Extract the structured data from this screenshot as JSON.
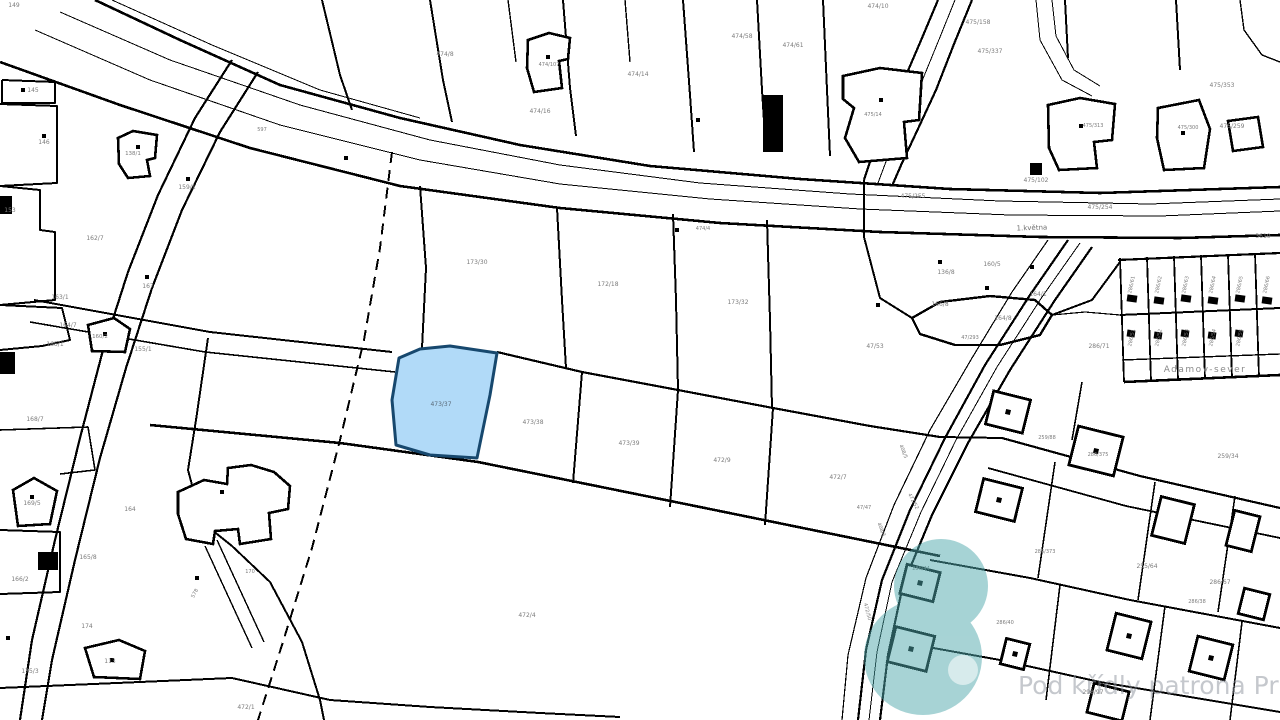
{
  "map": {
    "type": "cadastral-map",
    "background": "#ffffff",
    "line_color": "#000000",
    "label_color": "#7b7b7b",
    "highlight": {
      "parcel_number": "473/37",
      "fill": "#a9d6f7",
      "stroke": "#17486e",
      "points": "399,358 420,349 450,346 497,353 490,395 477,458 430,455 396,445 392,400",
      "label_x": 441,
      "label_y": 406,
      "label_color": "#5a6a78"
    },
    "watermark": {
      "text": "Pod křídly patrona Prahy",
      "text_color": "rgba(140,145,155,0.5)",
      "x": 1018,
      "y": 694,
      "size": 25,
      "logo_color": "#4fa8ac",
      "logo_opacity": 0.5
    },
    "street_labels": [
      {
        "t": "1.května",
        "x": 1032,
        "y": 230,
        "s": 7,
        "c": "#6f6f6f",
        "r": -2
      },
      {
        "t": "Adamov-sever",
        "x": 1205,
        "y": 372,
        "s": 9,
        "c": "#8a8a8a",
        "ls": 1.5
      }
    ],
    "parcel_labels": [
      {
        "t": "149",
        "x": 14,
        "y": 7
      },
      {
        "t": "145",
        "x": 33,
        "y": 92
      },
      {
        "t": "146",
        "x": 44,
        "y": 144
      },
      {
        "t": "138/1",
        "x": 133,
        "y": 155,
        "s": 5.5
      },
      {
        "t": "159/1",
        "x": 187,
        "y": 189
      },
      {
        "t": "597",
        "x": 262,
        "y": 131,
        "s": 5
      },
      {
        "t": "153",
        "x": 10,
        "y": 212
      },
      {
        "t": "162/7",
        "x": 95,
        "y": 240
      },
      {
        "t": "167",
        "x": 148,
        "y": 288
      },
      {
        "t": "163/1",
        "x": 60,
        "y": 299
      },
      {
        "t": "164/7",
        "x": 68,
        "y": 327
      },
      {
        "t": "165/1",
        "x": 55,
        "y": 346
      },
      {
        "t": "160/2",
        "x": 100,
        "y": 338,
        "s": 5.5
      },
      {
        "t": "155/1",
        "x": 143,
        "y": 351
      },
      {
        "t": "168/7",
        "x": 35,
        "y": 421
      },
      {
        "t": "169/5",
        "x": 32,
        "y": 505
      },
      {
        "t": "165/8",
        "x": 88,
        "y": 559
      },
      {
        "t": "166/2",
        "x": 20,
        "y": 581
      },
      {
        "t": "174",
        "x": 87,
        "y": 628
      },
      {
        "t": "113",
        "x": 110,
        "y": 663
      },
      {
        "t": "175/3",
        "x": 30,
        "y": 673
      },
      {
        "t": "164",
        "x": 130,
        "y": 511
      },
      {
        "t": "170",
        "x": 250,
        "y": 573,
        "s": 5
      },
      {
        "t": "578",
        "x": 196,
        "y": 594,
        "r": -62,
        "s": 5
      },
      {
        "t": "472/1",
        "x": 246,
        "y": 709
      },
      {
        "t": "474/8",
        "x": 445,
        "y": 56
      },
      {
        "t": "474/107",
        "x": 549,
        "y": 66,
        "s": 5
      },
      {
        "t": "474/16",
        "x": 540,
        "y": 113
      },
      {
        "t": "474/14",
        "x": 638,
        "y": 76
      },
      {
        "t": "474/58",
        "x": 742,
        "y": 38
      },
      {
        "t": "474/61",
        "x": 793,
        "y": 47
      },
      {
        "t": "474/10",
        "x": 878,
        "y": 8
      },
      {
        "t": "474/4",
        "x": 703,
        "y": 230,
        "s": 5
      },
      {
        "t": "475/158",
        "x": 978,
        "y": 24
      },
      {
        "t": "475/337",
        "x": 990,
        "y": 53
      },
      {
        "t": "475/313",
        "x": 1093,
        "y": 127,
        "s": 5
      },
      {
        "t": "475/353",
        "x": 1222,
        "y": 87
      },
      {
        "t": "475/14",
        "x": 873,
        "y": 116,
        "s": 5
      },
      {
        "t": "475/300",
        "x": 1188,
        "y": 129,
        "s": 5
      },
      {
        "t": "475/259",
        "x": 1232,
        "y": 128
      },
      {
        "t": "475/102",
        "x": 1036,
        "y": 182
      },
      {
        "t": "475/255",
        "x": 913,
        "y": 198
      },
      {
        "t": "475/254",
        "x": 1100,
        "y": 209
      },
      {
        "t": "3610",
        "x": 1263,
        "y": 238
      },
      {
        "t": "173/30",
        "x": 477,
        "y": 264
      },
      {
        "t": "172/18",
        "x": 608,
        "y": 286
      },
      {
        "t": "173/32",
        "x": 738,
        "y": 304
      },
      {
        "t": "136/8",
        "x": 946,
        "y": 274
      },
      {
        "t": "160/5",
        "x": 992,
        "y": 266
      },
      {
        "t": "164/1",
        "x": 1038,
        "y": 296
      },
      {
        "t": "164/8",
        "x": 1003,
        "y": 320
      },
      {
        "t": "166/8",
        "x": 940,
        "y": 306
      },
      {
        "t": "47/293",
        "x": 970,
        "y": 339,
        "s": 5
      },
      {
        "t": "47/53",
        "x": 875,
        "y": 348
      },
      {
        "t": "286/71",
        "x": 1099,
        "y": 348
      },
      {
        "t": "473/38",
        "x": 533,
        "y": 424
      },
      {
        "t": "473/39",
        "x": 629,
        "y": 445
      },
      {
        "t": "472/9",
        "x": 722,
        "y": 462
      },
      {
        "t": "472/7",
        "x": 838,
        "y": 479
      },
      {
        "t": "47/47",
        "x": 864,
        "y": 509,
        "s": 5
      },
      {
        "t": "472/4",
        "x": 527,
        "y": 617
      },
      {
        "t": "259/88",
        "x": 1047,
        "y": 439,
        "s": 5
      },
      {
        "t": "286/375",
        "x": 1098,
        "y": 456,
        "s": 5
      },
      {
        "t": "259/34",
        "x": 1228,
        "y": 458
      },
      {
        "t": "286/373",
        "x": 1045,
        "y": 553,
        "s": 5
      },
      {
        "t": "255/64",
        "x": 1147,
        "y": 568
      },
      {
        "t": "286/67",
        "x": 1220,
        "y": 584
      },
      {
        "t": "286/38",
        "x": 1197,
        "y": 603,
        "s": 5
      },
      {
        "t": "298/97",
        "x": 1093,
        "y": 694
      },
      {
        "t": "286/44",
        "x": 921,
        "y": 570,
        "s": 5
      },
      {
        "t": "286/40",
        "x": 1005,
        "y": 624,
        "s": 5
      },
      {
        "t": "472/52",
        "x": 912,
        "y": 502,
        "r": 62,
        "s": 5
      },
      {
        "t": "408/5",
        "x": 902,
        "y": 452,
        "r": 68,
        "s": 5
      },
      {
        "t": "408/3",
        "x": 880,
        "y": 530,
        "r": 68,
        "s": 5
      },
      {
        "t": "472/50",
        "x": 866,
        "y": 612,
        "r": 75,
        "s": 5
      },
      {
        "t": "286/61",
        "x": 1133,
        "y": 285,
        "r": -78,
        "s": 5
      },
      {
        "t": "286/62",
        "x": 1160,
        "y": 285,
        "r": -78,
        "s": 5
      },
      {
        "t": "286/63",
        "x": 1187,
        "y": 285,
        "r": -78,
        "s": 5
      },
      {
        "t": "286/64",
        "x": 1214,
        "y": 285,
        "r": -78,
        "s": 5
      },
      {
        "t": "286/65",
        "x": 1241,
        "y": 285,
        "r": -78,
        "s": 5
      },
      {
        "t": "286/66",
        "x": 1268,
        "y": 285,
        "r": -78,
        "s": 5
      },
      {
        "t": "286/51",
        "x": 1133,
        "y": 338,
        "r": -78,
        "s": 5
      },
      {
        "t": "286/52",
        "x": 1160,
        "y": 338,
        "r": -78,
        "s": 5
      },
      {
        "t": "286/53",
        "x": 1187,
        "y": 338,
        "r": -78,
        "s": 5
      },
      {
        "t": "286/54",
        "x": 1214,
        "y": 338,
        "r": -78,
        "s": 5
      },
      {
        "t": "286/55",
        "x": 1241,
        "y": 338,
        "r": -78,
        "s": 5
      }
    ],
    "lines": [
      {
        "p": "95,0 180,40 280,85 400,118 520,145 650,166 800,179 950,189 1100,193 1280,187",
        "w": 2.6
      },
      {
        "p": "60,12 170,60 300,105 430,140 560,165 700,183 850,194 1000,201 1150,204 1280,199",
        "w": 1
      },
      {
        "p": "35,30 150,80 280,125 420,160 560,184 710,199 860,209 1010,215 1160,216 1280,211",
        "w": 1
      },
      {
        "p": "0,62 120,105 250,148 400,186 560,208 720,223 880,232 1040,237 1180,238 1280,235",
        "w": 2.6
      },
      {
        "p": "112,0 212,45 320,90 420,118",
        "w": 1
      },
      {
        "p": "938,0 922,38 904,80 886,122 872,156 864,180",
        "w": 2.2
      },
      {
        "p": "972,0 954,44 936,90 917,131 902,163 892,186",
        "w": 2.2
      },
      {
        "p": "955,0 938,42 920,86 901,127 887,159 878,183",
        "w": 1
      },
      {
        "p": "232,60 195,118 158,195 128,272 103,350 80,438 55,540 32,640 20,720",
        "w": 2.2
      },
      {
        "p": "258,72 220,132 182,210 152,288 126,368 100,458 75,560 52,660 42,720",
        "w": 2.2
      },
      {
        "p": "392,152 380,248 364,340 340,440 312,548 282,645 258,720",
        "w": 2,
        "d": "11 7"
      },
      {
        "p": "34,300 210,332 392,352",
        "w": 2
      },
      {
        "p": "30,322 205,352 395,372",
        "w": 1.6
      },
      {
        "p": "497,352 582,372 678,390 773,408 870,426 940,437",
        "w": 2.2
      },
      {
        "p": "150,425 340,443 478,462 700,507 940,556",
        "w": 2.6
      },
      {
        "p": "582,372 573,483",
        "w": 2
      },
      {
        "p": "678,390 670,507",
        "w": 2
      },
      {
        "p": "773,408 765,525",
        "w": 2
      },
      {
        "p": "420,186 426,268 422,348",
        "w": 2
      },
      {
        "p": "557,208 562,300 566,368",
        "w": 2
      },
      {
        "p": "673,214 676,300 678,390",
        "w": 2
      },
      {
        "p": "767,220 770,320 772,408",
        "w": 2
      },
      {
        "p": "2,80 55,82 55,103 2,103 2,80",
        "w": 2
      },
      {
        "p": "0,104 57,106 57,183 0,186",
        "w": 2
      },
      {
        "p": "0,186 40,190 40,230 55,232 55,300 0,305",
        "w": 2
      },
      {
        "p": "0,305 62,308 70,340 42,346 0,350",
        "w": 2
      },
      {
        "p": "0,430 88,427 95,470 60,474",
        "w": 1.6
      },
      {
        "p": "0,530 60,532 60,592 0,594",
        "w": 2
      },
      {
        "p": "208,338 196,420 188,470 202,522 232,546",
        "w": 2
      },
      {
        "p": "205,546 252,648",
        "w": 1.4
      },
      {
        "p": "217,540 264,642",
        "w": 1.4
      },
      {
        "p": "232,546 270,582 302,642 320,700 324,720",
        "w": 2
      },
      {
        "p": "0,688 140,682 232,678 330,700 430,707 540,713 620,717",
        "w": 2
      },
      {
        "p": "912,318 940,302 990,296 1035,300 1052,315 1040,335 1000,345 955,345 920,334 912,318",
        "w": 2.4
      },
      {
        "p": "864,237 880,298 912,318",
        "w": 2
      },
      {
        "p": "1052,315 1092,300 1120,262",
        "w": 2
      },
      {
        "p": "1052,315 1085,312 1120,315",
        "w": 1.2
      },
      {
        "p": "1118,260 1280,253",
        "w": 2.2
      },
      {
        "p": "1120,315 1280,308",
        "w": 2
      },
      {
        "p": "1122,360 1280,354",
        "w": 1.4
      },
      {
        "p": "1124,382 1280,375",
        "w": 2.6
      },
      {
        "p": "1120,258 1124,382",
        "w": 1.8
      },
      {
        "p": "1147,257 1151,381",
        "w": 1.8
      },
      {
        "p": "1174,256 1178,380",
        "w": 1.8
      },
      {
        "p": "1201,255 1205,379",
        "w": 1.8
      },
      {
        "p": "1228,254 1232,378",
        "w": 1.8
      },
      {
        "p": "1255,253 1259,377",
        "w": 1.8
      },
      {
        "p": "1068,240 1030,295 985,365 945,438 910,510 882,580 866,650 858,720",
        "w": 2.2
      },
      {
        "p": "1092,247 1055,300 1010,370 968,443 932,515 903,585 888,655 880,720",
        "w": 2.2
      },
      {
        "p": "1080,243 1042,297 997,367 956,440 921,512 892,582 877,652 869,720",
        "w": 1
      },
      {
        "p": "1048,240 1012,292 972,358 930,430 894,505 866,578 848,655 842,720",
        "w": 1.2
      },
      {
        "p": "1002,438 1140,476 1280,508",
        "w": 2.2
      },
      {
        "p": "988,468 1126,506 1280,538",
        "w": 1.8
      },
      {
        "p": "930,560 1030,578 1130,600 1280,628",
        "w": 2
      },
      {
        "p": "900,642 1000,660 1100,682 1280,712",
        "w": 2
      },
      {
        "p": "1055,462 1038,578",
        "w": 1.6
      },
      {
        "p": "1155,482 1138,600",
        "w": 1.6
      },
      {
        "p": "1235,496 1218,612",
        "w": 1.6
      },
      {
        "p": "1060,585 1046,700",
        "w": 1.6
      },
      {
        "p": "1165,606 1150,720",
        "w": 1.6
      },
      {
        "p": "1242,622 1230,720",
        "w": 1.6
      },
      {
        "p": "1082,382 1072,440",
        "w": 1.6
      },
      {
        "p": "322,0 340,75 352,110",
        "w": 2
      },
      {
        "p": "430,0 443,80 452,122",
        "w": 2
      },
      {
        "p": "508,0 516,62",
        "w": 1.4
      },
      {
        "p": "563,0 570,88 576,136",
        "w": 2
      },
      {
        "p": "625,0 630,62",
        "w": 1.4
      },
      {
        "p": "683,0 690,95 694,152",
        "w": 2
      },
      {
        "p": "757,0 762,90 766,152",
        "w": 2
      },
      {
        "p": "823,0 827,90 830,156",
        "w": 2
      },
      {
        "p": "1065,0 1068,58",
        "w": 2
      },
      {
        "p": "1176,0 1180,70",
        "w": 2
      },
      {
        "p": "1036,0 1040,40 1062,80 1092,96",
        "w": 1
      },
      {
        "p": "1052,0 1056,36 1074,70 1100,86",
        "w": 1
      },
      {
        "p": "1240,0 1244,30 1262,55 1280,62",
        "w": 1.4
      },
      {
        "p": "864,180 864,237",
        "w": 2
      },
      {
        "p": "940,437 1002,438",
        "w": 2
      }
    ],
    "buildings": [
      {
        "p": "118,138 133,131 157,135 155,158 147,160 150,176 128,178 119,164"
      },
      {
        "p": "528,40 549,33 570,38 568,59 559,61 562,88 534,92 527,68"
      },
      {
        "p": "843,76 880,68 922,73 919,120 904,122 907,158 859,162 845,138 854,108 843,99"
      },
      {
        "p": "1048,105 1080,98 1115,104 1112,140 1094,142 1097,168 1059,170 1049,148"
      },
      {
        "p": "1158,108 1199,100 1210,129 1204,168 1164,170 1157,138"
      },
      {
        "p": "1228,121 1258,117 1263,147 1233,151"
      },
      {
        "p": "178,492 204,480 227,484 228,468 251,465 274,472 290,486 288,509 269,513 271,539 240,544 238,529 215,531 213,544 186,539 178,514"
      },
      {
        "p": "85,648 119,640 145,651 140,679 94,677"
      },
      {
        "p": "13,490 34,478 57,491 50,524 18,526"
      },
      {
        "p": "88,325 114,318 130,329 125,352 92,351"
      }
    ],
    "square_houses": [
      {
        "cx": 999,
        "cy": 500,
        "w": 40,
        "h": 34,
        "r": 14,
        "dot": 1
      },
      {
        "cx": 1096,
        "cy": 451,
        "w": 46,
        "h": 40,
        "r": 14,
        "dot": 1
      },
      {
        "cx": 1173,
        "cy": 520,
        "w": 34,
        "h": 40,
        "r": 14,
        "dot": 0
      },
      {
        "cx": 1243,
        "cy": 531,
        "w": 26,
        "h": 36,
        "r": 14,
        "dot": 0
      },
      {
        "cx": 920,
        "cy": 583,
        "w": 34,
        "h": 30,
        "r": 14,
        "dot": 1
      },
      {
        "cx": 911,
        "cy": 649,
        "w": 40,
        "h": 36,
        "r": 14,
        "dot": 1
      },
      {
        "cx": 1015,
        "cy": 654,
        "w": 24,
        "h": 26,
        "r": 14,
        "dot": 1
      },
      {
        "cx": 1129,
        "cy": 636,
        "w": 36,
        "h": 38,
        "r": 14,
        "dot": 1
      },
      {
        "cx": 1211,
        "cy": 658,
        "w": 36,
        "h": 36,
        "r": 14,
        "dot": 1
      },
      {
        "cx": 1108,
        "cy": 702,
        "w": 36,
        "h": 30,
        "r": 14,
        "dot": 0
      },
      {
        "cx": 1008,
        "cy": 412,
        "w": 38,
        "h": 34,
        "r": 14,
        "dot": 1
      },
      {
        "cx": 1254,
        "cy": 604,
        "w": 26,
        "h": 26,
        "r": 14,
        "dot": 0
      }
    ],
    "filled_buildings": [
      {
        "x": 763,
        "y": 95,
        "w": 20,
        "h": 57,
        "r": 0
      },
      {
        "x": 0,
        "y": 196,
        "w": 12,
        "h": 18,
        "r": 0
      },
      {
        "x": 0,
        "y": 352,
        "w": 15,
        "h": 22,
        "r": 0
      },
      {
        "x": 38,
        "y": 552,
        "w": 20,
        "h": 18,
        "r": 0
      },
      {
        "x": 1030,
        "y": 163,
        "w": 12,
        "h": 12,
        "r": 0
      },
      {
        "x": 1127,
        "y": 295,
        "w": 10,
        "h": 7,
        "r": 8
      },
      {
        "x": 1154,
        "y": 297,
        "w": 10,
        "h": 7,
        "r": 8
      },
      {
        "x": 1181,
        "y": 295,
        "w": 10,
        "h": 7,
        "r": 8
      },
      {
        "x": 1208,
        "y": 297,
        "w": 10,
        "h": 7,
        "r": 8
      },
      {
        "x": 1235,
        "y": 295,
        "w": 10,
        "h": 7,
        "r": 8
      },
      {
        "x": 1262,
        "y": 297,
        "w": 10,
        "h": 7,
        "r": 8
      },
      {
        "x": 1127,
        "y": 330,
        "w": 8,
        "h": 7,
        "r": 8
      },
      {
        "x": 1154,
        "y": 332,
        "w": 8,
        "h": 7,
        "r": 8
      },
      {
        "x": 1181,
        "y": 330,
        "w": 8,
        "h": 7,
        "r": 8
      },
      {
        "x": 1208,
        "y": 332,
        "w": 8,
        "h": 7,
        "r": 8
      },
      {
        "x": 1235,
        "y": 330,
        "w": 8,
        "h": 7,
        "r": 8
      }
    ],
    "dots": [
      [
        23,
        90
      ],
      [
        44,
        136
      ],
      [
        138,
        147
      ],
      [
        188,
        179
      ],
      [
        147,
        277
      ],
      [
        698,
        120
      ],
      [
        548,
        57
      ],
      [
        881,
        100
      ],
      [
        1081,
        126
      ],
      [
        1183,
        133
      ],
      [
        105,
        334
      ],
      [
        112,
        660
      ],
      [
        32,
        497
      ],
      [
        222,
        492
      ],
      [
        197,
        578
      ],
      [
        8,
        638
      ],
      [
        940,
        262
      ],
      [
        987,
        288
      ],
      [
        1032,
        267
      ],
      [
        878,
        305
      ],
      [
        677,
        230
      ],
      [
        346,
        158
      ]
    ]
  }
}
